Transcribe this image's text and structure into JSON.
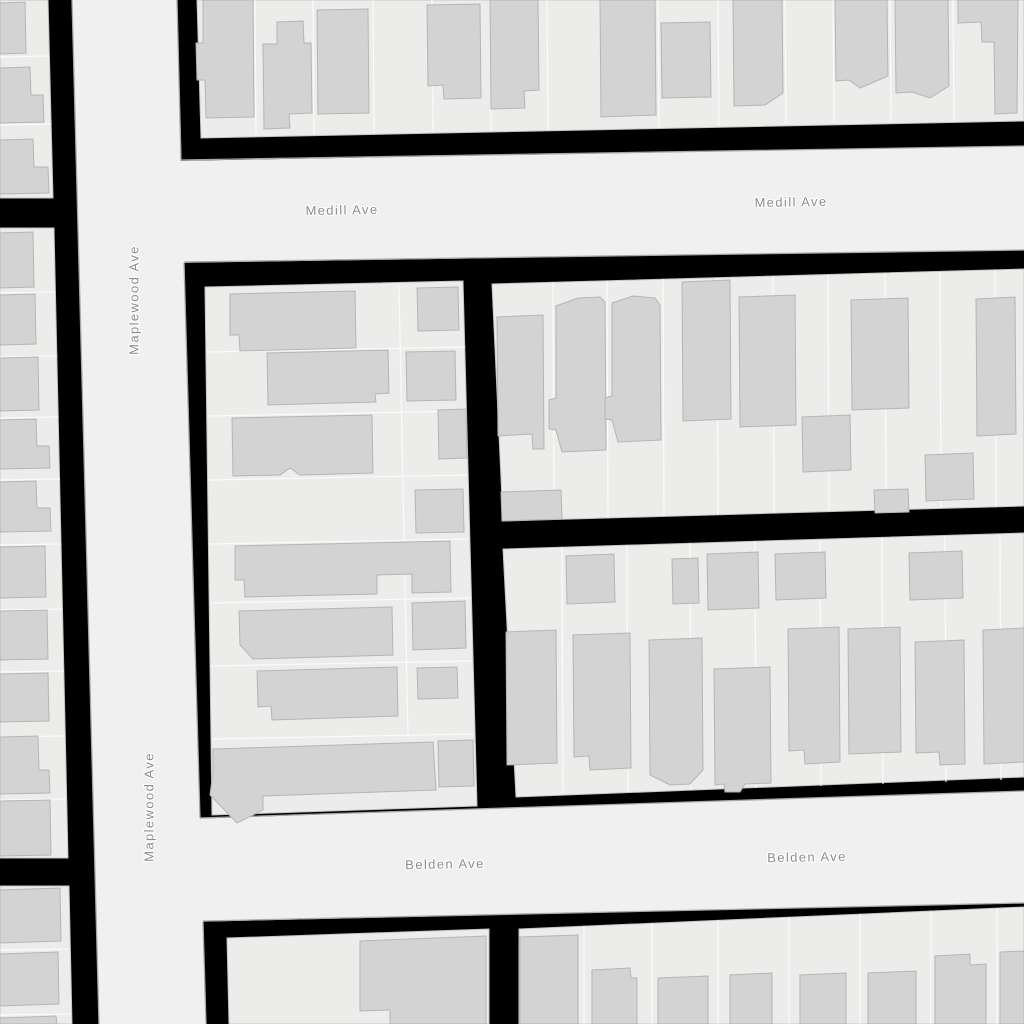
{
  "map": {
    "street_names": [
      "Medill Ave",
      "Maplewood Ave",
      "Belden Ave"
    ],
    "colors": {
      "background": "#000000",
      "road_fill": "#f0f0f0",
      "road_casing": "#a8a8a8",
      "parcel_fill": "#ececeb",
      "block_stroke": "#c4c4c4",
      "parcel_line": "#fafafa",
      "building_fill": "#d3d3d3",
      "building_stroke": "#b5b5b5",
      "label_color": "#8d8d8d",
      "label_halo": "#ffffff"
    },
    "labels": [
      {
        "id": "medill-ave-label-1",
        "text": "Medill Ave",
        "x": 342,
        "y": 210,
        "rotation": -1
      },
      {
        "id": "medill-ave-label-2",
        "text": "Medill Ave",
        "x": 791,
        "y": 202,
        "rotation": -1
      },
      {
        "id": "maplewood-ave-label-1",
        "text": "Maplewood Ave",
        "x": 134,
        "y": 300,
        "rotation": -90
      },
      {
        "id": "maplewood-ave-label-2",
        "text": "Maplewood Ave",
        "x": 149,
        "y": 807,
        "rotation": -90
      },
      {
        "id": "belden-ave-label-1",
        "text": "Belden Ave",
        "x": 445,
        "y": 864,
        "rotation": -1
      },
      {
        "id": "belden-ave-label-2",
        "text": "Belden Ave",
        "x": 807,
        "y": 857,
        "rotation": -1
      }
    ],
    "geometry": {
      "streets": [
        {
          "name": "maplewood-ave-road",
          "points": "72,0 177,0 206,1024 99,1024"
        },
        {
          "name": "medill-ave-road",
          "points": "170,161 1024,146 1024,250 173,263"
        },
        {
          "name": "belden-ave-road",
          "points": "186,819 1024,791 1024,903 190,922"
        }
      ],
      "road_edges": [
        "72,0 99,1024",
        "177,0 181,161",
        "184,263 200,818",
        "203,922 206,1024",
        "181,160 1024,146",
        "184,262 1024,250",
        "200,818 1024,791",
        "203,921 1024,903"
      ],
      "blocks": [
        {
          "name": "block-north",
          "points": "197,0 1024,0 1024,121 201,138"
        },
        {
          "name": "block-west-upper",
          "points": "0,0 48,0 53,198 0,198"
        },
        {
          "name": "block-west-middle",
          "points": "0,228 54,228 68,858 0,858"
        },
        {
          "name": "block-west-lower",
          "points": "0,886 69,886 72,1024 0,1024"
        },
        {
          "name": "block-mid-west",
          "points": "205,287 463,281 477,806 212,815"
        },
        {
          "name": "block-mid-east-upper",
          "points": "492,284 1024,269 1024,506 503,521"
        },
        {
          "name": "block-mid-east-lower",
          "points": "503,549 1024,533 1024,777 516,797"
        },
        {
          "name": "block-south-west",
          "points": "227,938 489,929 489,1024 229,1024"
        },
        {
          "name": "block-south-east",
          "points": "519,929 1024,907 1024,1024 519,1024"
        }
      ],
      "parcel_lines": [
        "0,57 49,56",
        "0,125 51,124",
        "0,293 55,292",
        "0,357 57,356",
        "0,418 58,417",
        "0,480 60,479",
        "0,545 61,544",
        "0,610 62,609",
        "0,672 64,671",
        "0,737 65,736",
        "0,800 66,799",
        "0,950 70,949",
        "0,1015 71,1014",
        "255,0 256,136",
        "313,0 314,134",
        "373,0 374,133",
        "432,0 433,132",
        "490,0 491,131",
        "547,0 548,130",
        "658,0 659,127",
        "718,0 719,126",
        "785,0 786,124",
        "833,0 834,123",
        "890,0 891,122",
        "953,0 954,121",
        "206,352 465,347",
        "207,416 466,411",
        "208,480 468,475",
        "209,544 469,539",
        "210,603 470,598",
        "210,666 471,661",
        "212,739 473,734",
        "399,286 408,737",
        "553,282 554,519",
        "607,281 608,518",
        "663,279 664,516",
        "717,278 718,515",
        "773,276 774,513",
        "828,275 829,511",
        "885,273 886,510",
        "940,272 941,508",
        "995,270 996,507",
        "562,547 563,794",
        "627,545 628,792",
        "690,543 691,790",
        "755,541 756,788",
        "820,540 821,786",
        "882,538 883,784",
        "945,536 946,782",
        "1000,535 1001,780",
        "584,926 584,1024",
        "652,923 652,1024",
        "718,920 718,1024",
        "789,917 789,1024",
        "860,914 860,1024",
        "931,911 931,1024",
        "997,908 997,1024"
      ],
      "buildings": [
        "0,3 25,2 26,53 0,54",
        "0,68 30,67 31,95 43,95 44,122 0,123",
        "0,140 33,139 34,167 48,167 49,193 0,194",
        "0,233 33,232 34,287 0,288",
        "0,295 35,294 36,344 0,345",
        "0,358 38,357 39,410 0,411",
        "0,420 36,419 37,446 49,446 50,468 0,469",
        "0,482 36,481 37,508 50,508 51,531 0,532",
        "0,547 45,546 46,597 0,598",
        "0,611 47,610 48,659 0,660",
        "0,674 48,673 49,721 0,722",
        "0,737 38,736 39,770 49,770 50,793 0,794",
        "0,801 50,800 51,855 0,856",
        "0,890 60,888 61,941 0,943",
        "0,954 58,952 59,1004 0,1006",
        "0,1018 56,1016 57,1024 0,1024",
        "203,0 253,0 254,117 206,118 205,80 197,80 196,43 203,43",
        "277,22 303,21 304,43 311,43 312,113 289,114 290,128 264,129 263,44 277,44",
        "317,10 368,9 369,113 318,114",
        "427,5 480,4 481,98 444,99 443,85 428,86",
        "490,0 538,0 539,90 524,91 525,108 491,109",
        "600,0 655,0 656,115 601,117",
        "661,23 710,22 711,97 662,98",
        "733,0 782,0 783,93 765,105 734,106",
        "835,0 887,0 888,76 860,88 849,80 836,81",
        "895,0 948,0 949,86 930,98 912,92 896,93",
        "958,0 1018,0 1017,113 995,114 994,42 982,42 981,22 958,23",
        "230,294 355,291 356,348 240,351 239,335 230,335",
        "417,288 458,287 459,330 418,331",
        "267,353 388,350 389,393 375,394 376,402 268,405",
        "406,352 455,351 456,400 407,401",
        "232,418 372,415 373,473 300,475 290,468 280,475 233,476",
        "438,410 466,409 467,458 439,459",
        "415,490 463,489 464,532 416,533",
        "235,546 450,541 451,592 412,593 412,574 377,575 377,594 245,597 244,580 235,580",
        "239,611 392,607 393,655 253,659 240,645",
        "412,603 465,601 466,648 413,650",
        "257,671 397,667 398,716 272,720 271,706 258,707",
        "417,668 457,667 458,698 418,699",
        "213,749 433,742 436,790 263,796 263,810 237,823 210,795 213,772",
        "438,741 473,740 474,786 439,787",
        "497,317 543,315 544,449 533,449 532,434 498,436",
        "556,306 578,298 600,297 605,302 606,450 562,452 556,430 549,429 549,400 556,398",
        "612,303 633,296 655,298 660,305 661,440 618,442 612,420 605,419 605,398 612,396",
        "682,282 730,280 731,419 683,421",
        "739,297 795,295 796,425 740,427",
        "802,417 850,415 851,470 803,472",
        "851,300 908,298 909,408 852,410",
        "874,490 908,489 909,512 875,513",
        "925,455 973,453 974,499 926,501",
        "976,299 1015,297 1016,434 977,436",
        "501,492 561,490 562,519 502,521",
        "566,556 614,554 615,602 567,604",
        "672,559 698,558 699,603 673,604",
        "707,554 758,552 759,608 708,610",
        "775,554 825,552 826,598 776,600",
        "909,553 962,551 963,598 910,600",
        "506,632 556,630 557,763 507,765",
        "573,635 630,633 631,768 590,770 589,756 574,757",
        "649,640 702,638 703,770 690,784 670,785 650,775",
        "714,669 770,667 771,783 745,784 740,792 725,792 724,784 715,785",
        "788,629 839,627 840,762 805,764 804,750 789,751",
        "848,629 900,627 901,752 849,754",
        "915,642 964,640 965,764 940,765 939,752 916,753",
        "983,630 1024,628 1024,762 984,764",
        "360,941 486,936 486,1024 390,1024 390,1010 360,1011",
        "520,937 578,935 578,1024 520,1024",
        "592,970 630,968 631,978 637,978 637,1024 592,1024",
        "658,978 708,976 708,1024 658,1024",
        "730,975 772,973 772,1024 730,1024",
        "800,975 846,973 846,1024 800,1024",
        "868,973 916,971 916,1024 868,1024",
        "935,956 970,954 970,965 986,964 986,1024 935,1024",
        "1000,952 1024,951 1024,1024 1000,1024"
      ]
    }
  }
}
